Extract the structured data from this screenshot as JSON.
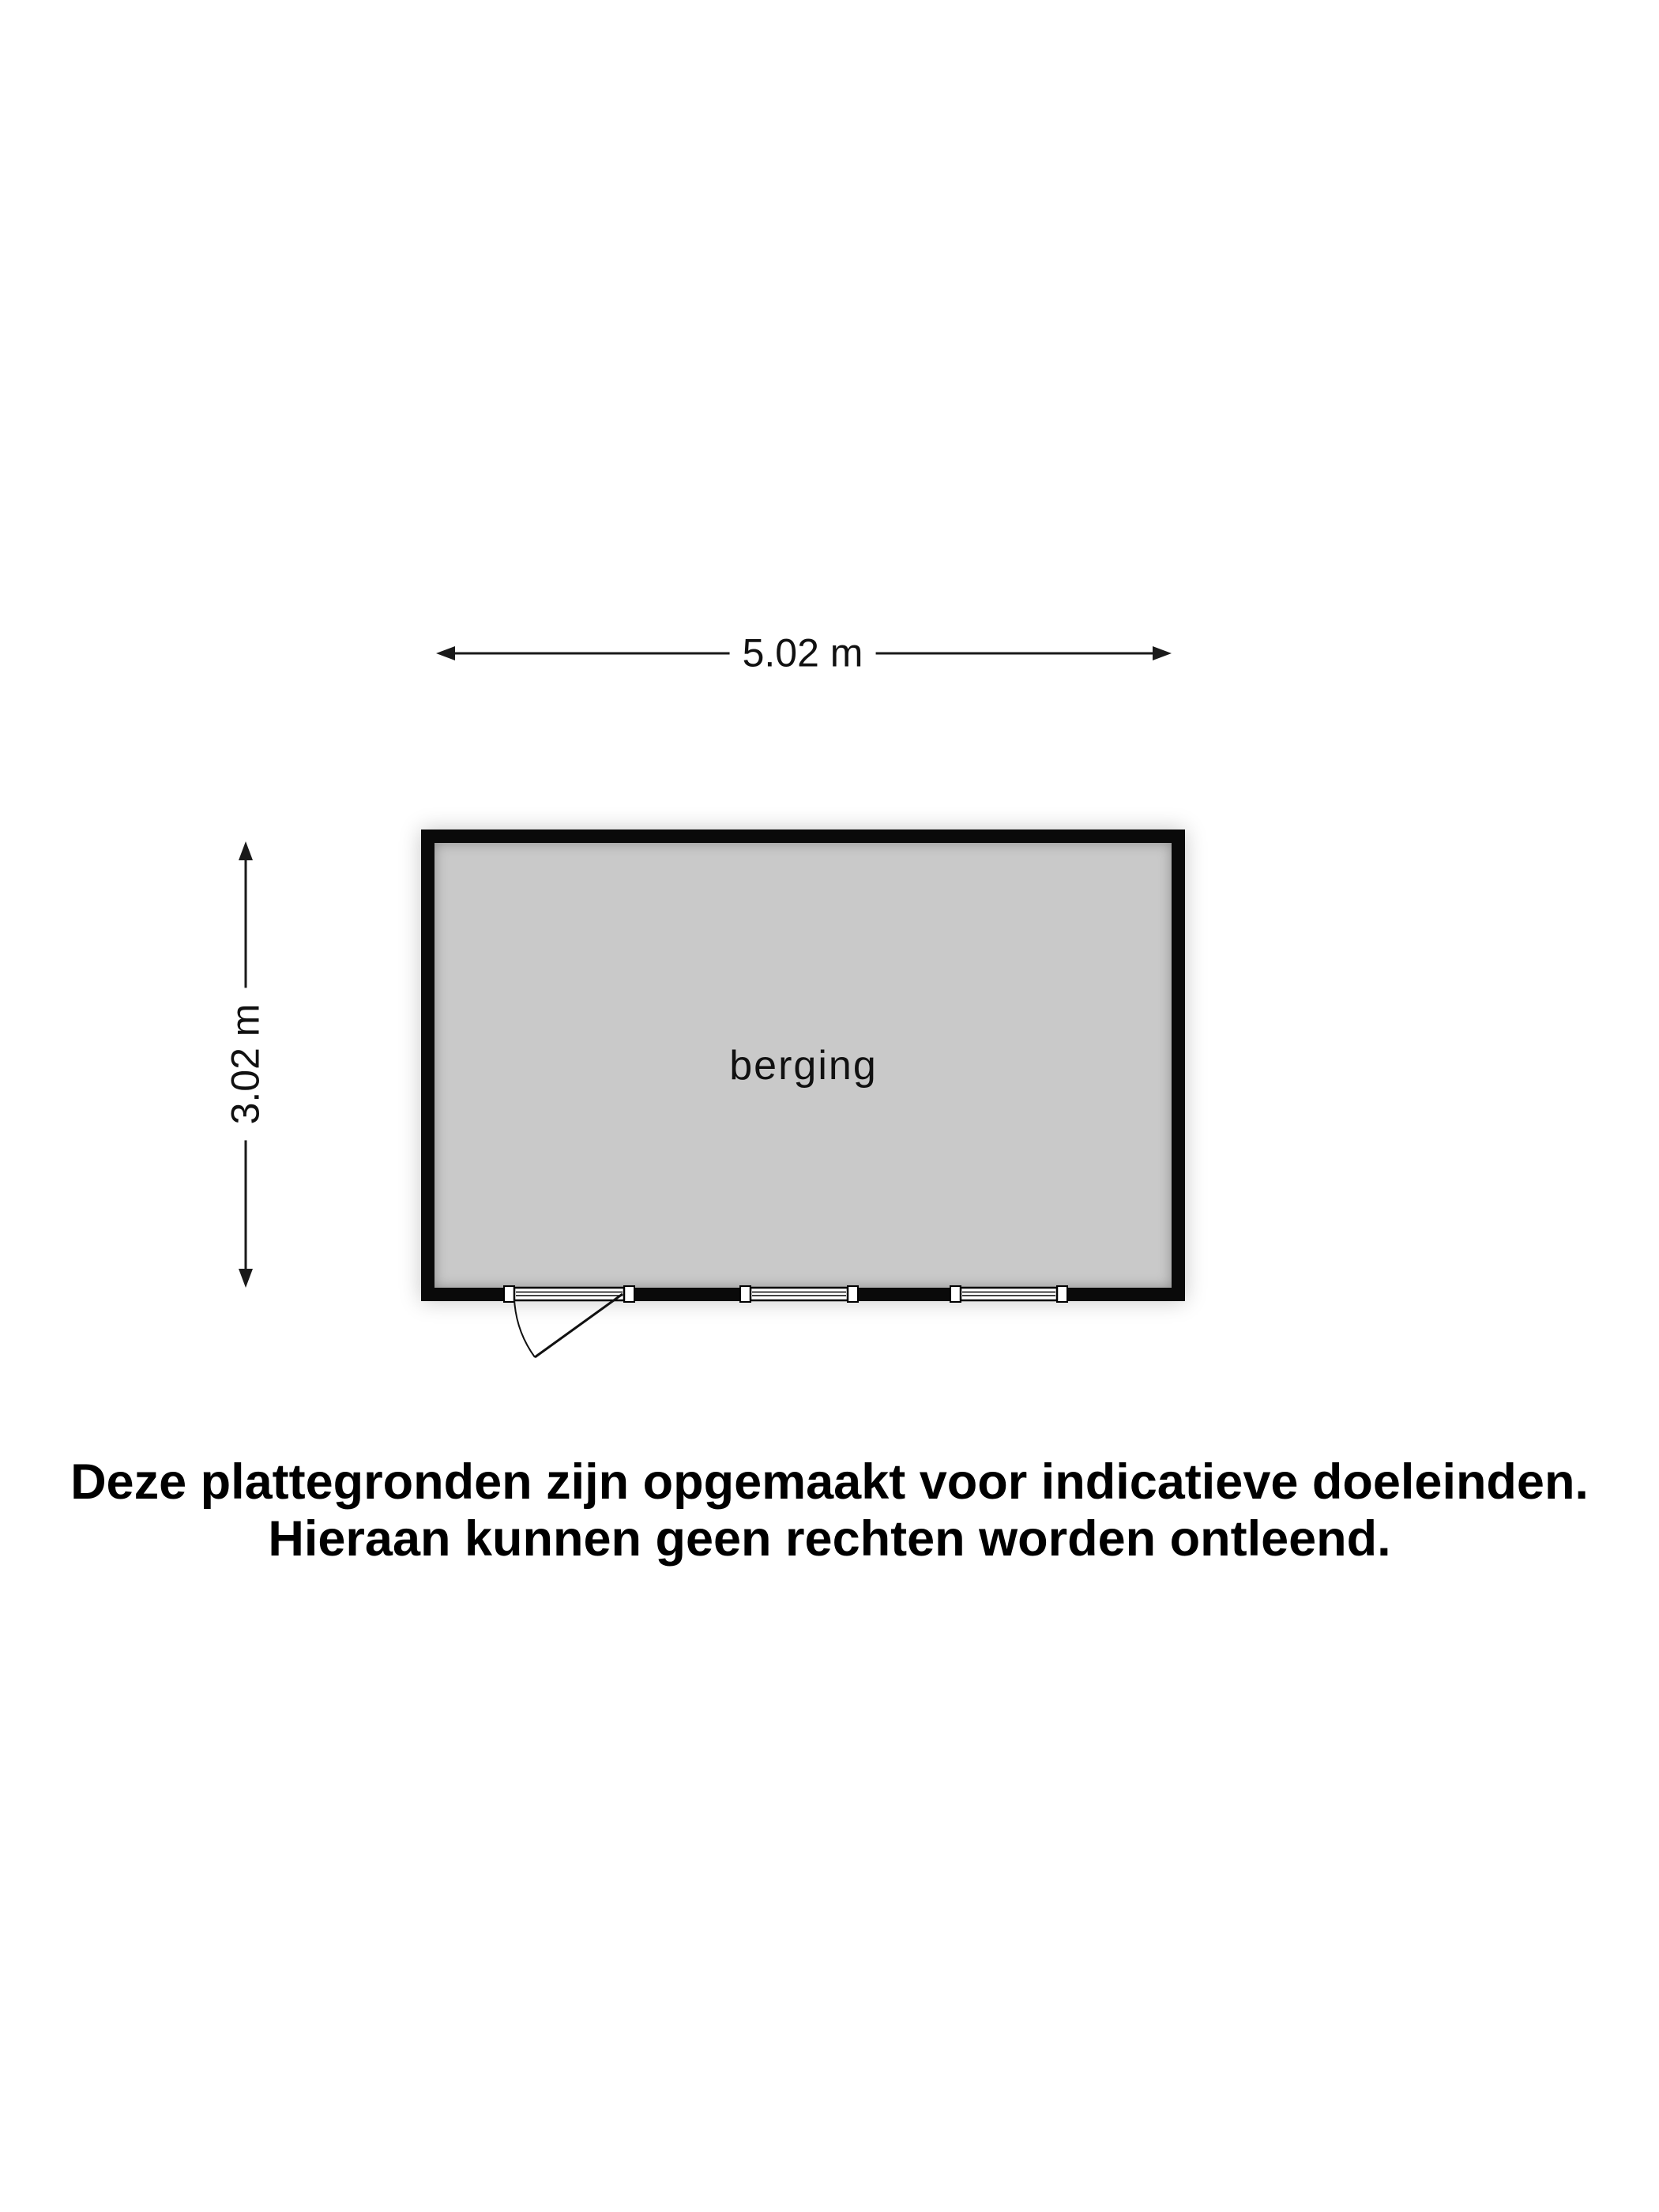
{
  "floorplan": {
    "room_label": "berging",
    "width_dimension": "5.02 m",
    "height_dimension": "3.02 m"
  },
  "disclaimer": {
    "line1": "Deze plattegronden zijn opgemaakt voor indicatieve doeleinden.",
    "line2": "Hieraan kunnen geen rechten worden ontleend."
  },
  "colors": {
    "wall": "#0a0a0a",
    "floor": "#c9c9c9",
    "background": "#ffffff",
    "line": "#1a1a1a",
    "text": "#111111"
  }
}
